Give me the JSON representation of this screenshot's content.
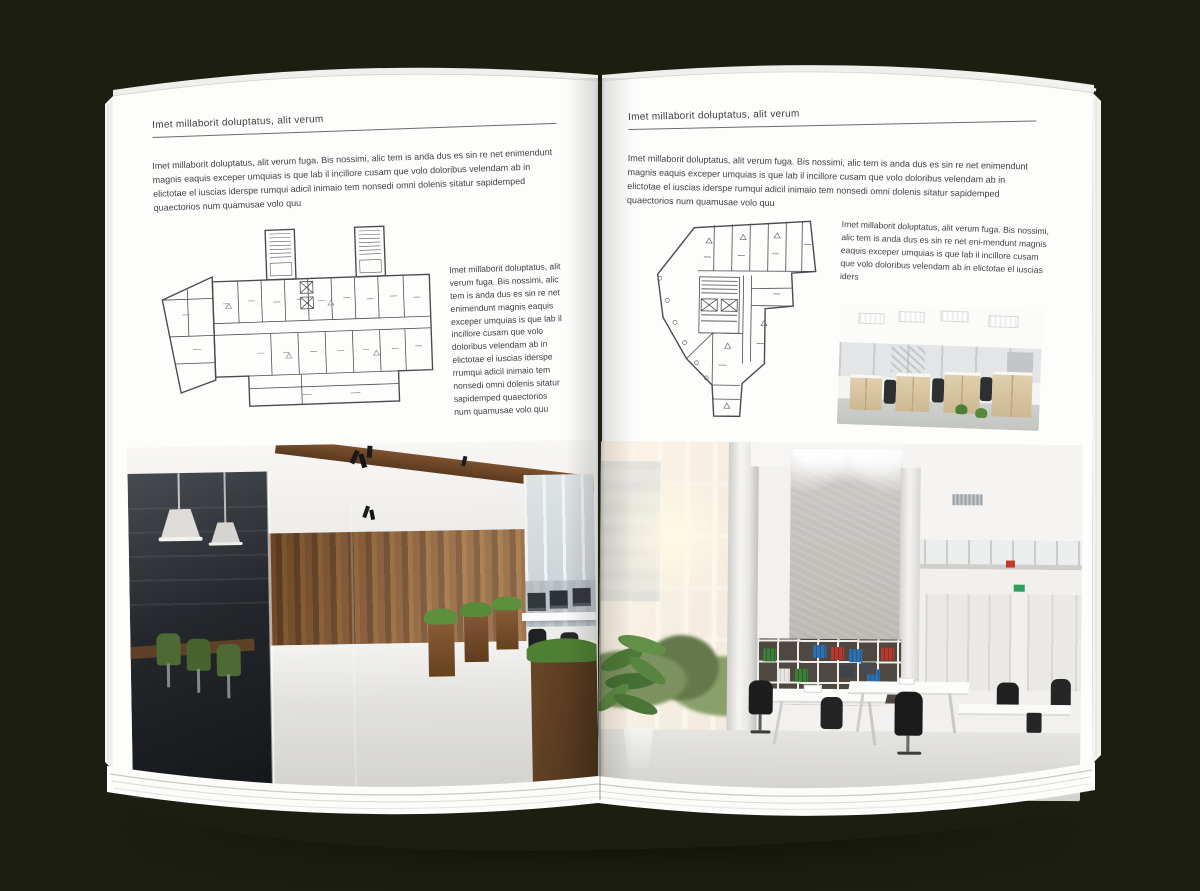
{
  "canvas": {
    "background_color": "#1b1e10",
    "page_color": "#fdfdfc",
    "accent_wood_color": "#8a5a33",
    "plan_line_color": "#4a4a4a"
  },
  "left_page": {
    "header": "Imet millaborit doluptatus, alit verum",
    "intro": "Imet millaborit doluptatus, alit verum fuga. Bis nossimi, alic tem is anda dus es sin re net enimendunt magnis eaquis exceper umquias is que lab il incillore cusam que volo doloribus velendam ab in elictotae el iuscias iderspe rumqui adicil inimaio tem nonsedi omni dolenis sitatur sapidemped quaectorios num quamusae volo quu",
    "side_text": "Imet millaborit doluptatus, alit verum fuga. Bis nossimi, alic tem is anda dus es sin re net enimendunt magnis eaquis exceper umquias is que lab il incillore cusam que volo doloribus velendam ab in elictotae el iuscias iderspe rrumqui adicil inimaio tem nonsedi omni dolenis sitatur sapidemped quaectorios num quamusae volo quu",
    "floor_plan": "wide office building plan with two stair towers and angled left wing",
    "photo": "dark loft office: glass meeting room, green chairs, wood plank wall, white floor, window workstations"
  },
  "right_page": {
    "header": "Imet millaborit doluptatus, alit verum",
    "intro": "Imet millaborit doluptatus, alit verum fuga. Bis nossimi, alic tem is anda dus es sin re net enimendunt magnis eaquis exceper umquias is que lab il incillore cusam que volo doloribus velendam ab in elictotae el iuscias iderspe rumqui adicil inimaio tem nonsedi omni dolenis sitatur sapidemped quaectorios num quamusae volo quu",
    "side_text": "Imet millaborit doluptatus, alit verum fuga. Bis nossimi, alic tem is anda dus es sin re net eni-mendunt magnis eaquis exceper umquias is que lab il incillore cusam que volo doloribus velendam ab in elictotae el iuscias iders",
    "floor_plan": "irregular tower floor plan with central core and lower stem",
    "photo_small": "bright open office with ceiling light panels, light wood cabinets and black chairs",
    "photo_large": "double-height white office: glazed wall with sunlight, concrete wall, binder bookshelf, white desks, mezzanine"
  }
}
